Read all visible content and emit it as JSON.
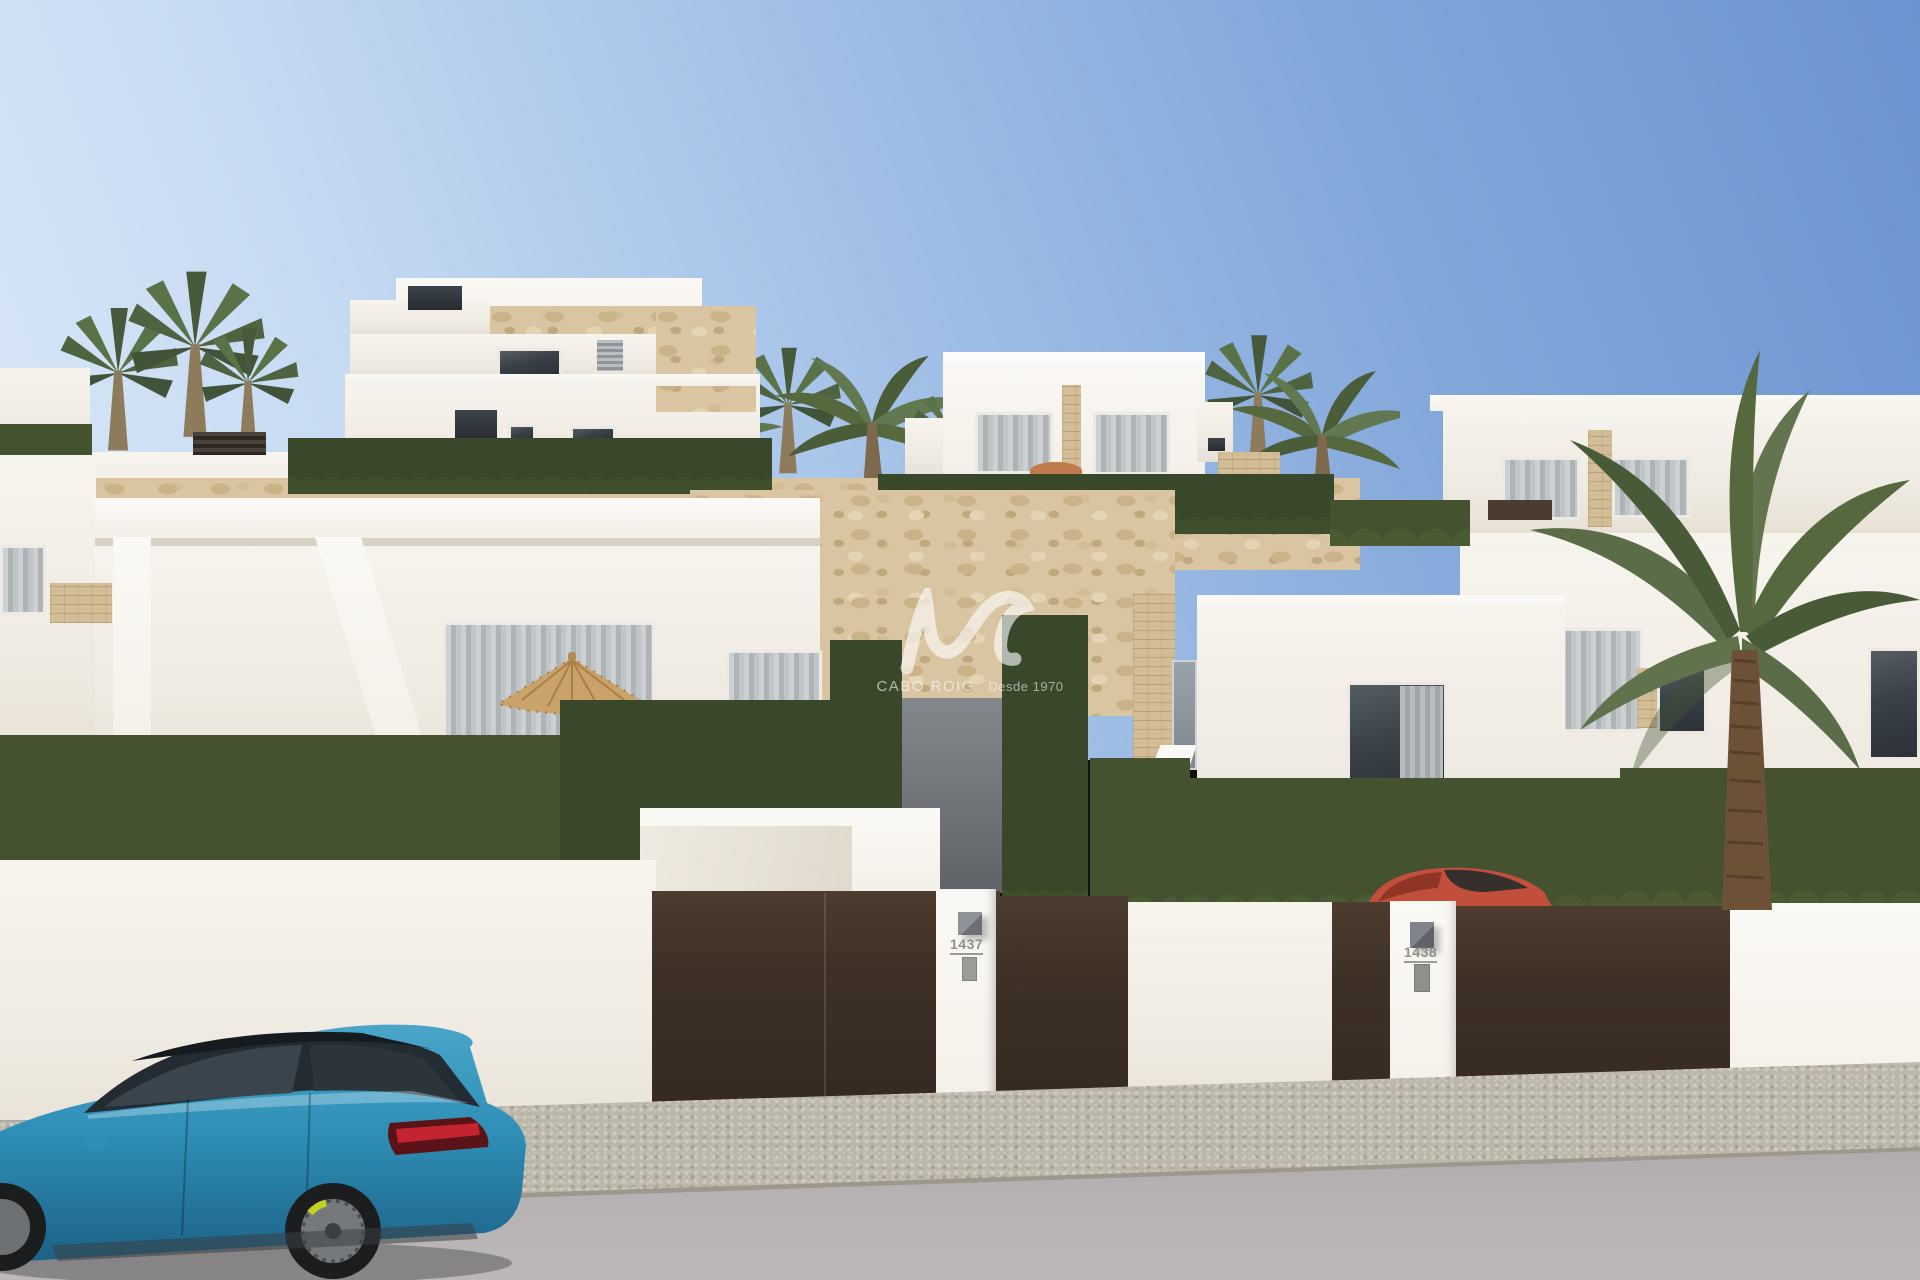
{
  "scene": {
    "description": "Sunny 3D architectural render: street view of modern white new-build villas with travertine stone accents, trimmed hedges, dark brown entrance gates, palm trees, a blue estate car parked on the road and a red car behind a gate."
  },
  "watermark": {
    "brand": "CABO ROIG",
    "tagline": "Desde 1970",
    "logo": "wave-monogram",
    "color": "#ffffff"
  },
  "properties": {
    "left_gate_number": "1437",
    "right_gate_number": "1438"
  },
  "palette": {
    "sky_top": "#6b93d1",
    "sky_horizon": "#dbe9f8",
    "wall_white": "#f4f0e9",
    "stone_travertine": "#d9c5a2",
    "hedge_green": "#44522f",
    "gate_brown": "#3b2e25",
    "road_gray": "#b2adaf",
    "sidewalk_gray": "#bcb7ab",
    "car_blue": "#2f8fb7",
    "car_red": "#c14f3c",
    "palm_green": "#56683f"
  }
}
